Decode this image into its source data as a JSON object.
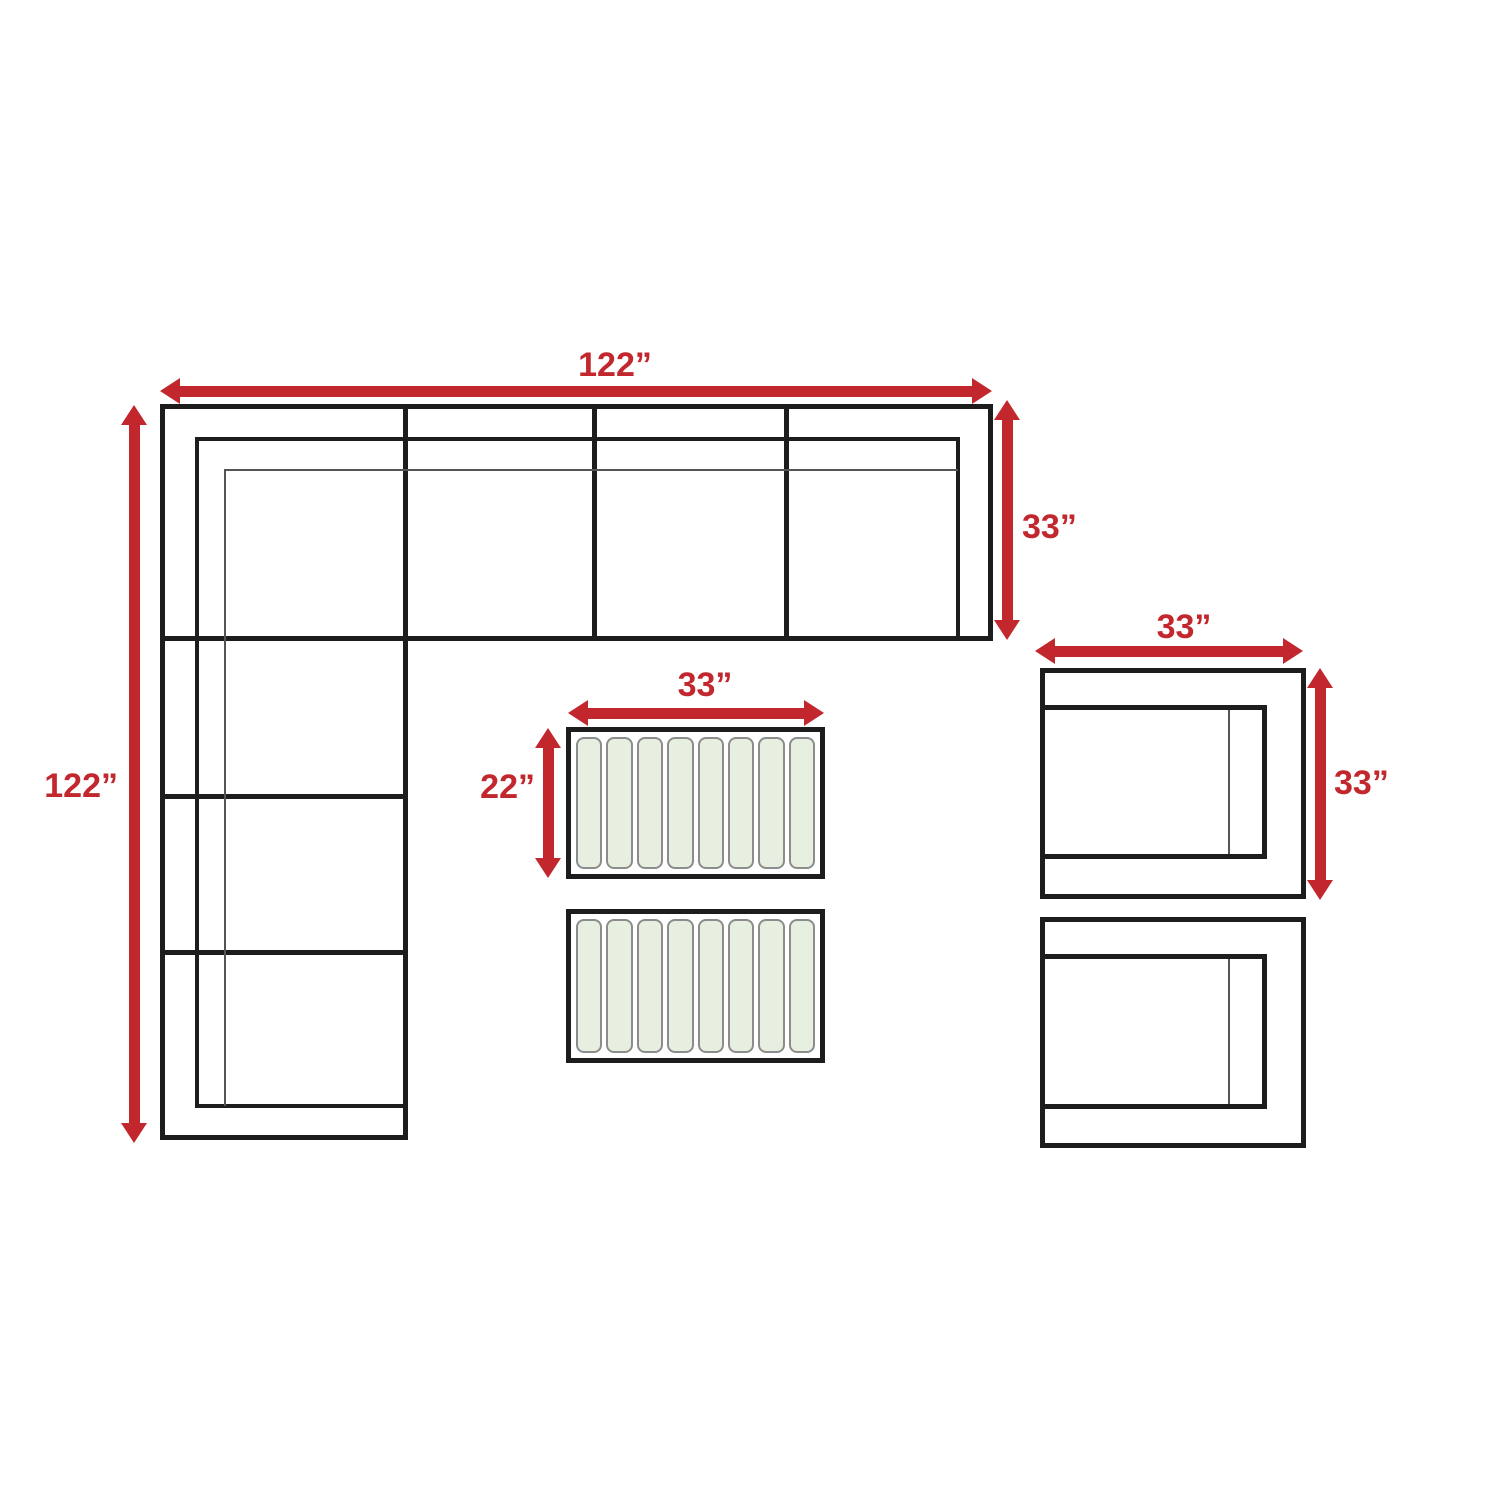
{
  "diagram": {
    "description": "Top-view dimension plan of an outdoor sectional set: L-shaped sectional sofa, two slatted coffee tables, two club chairs",
    "colors": {
      "dimension_red": "#c1272d",
      "outline": "#1d1d1d",
      "thin_line": "#555555",
      "slat_fill": "#e6efe0",
      "slat_border": "#8c8c8c",
      "background": "#ffffff"
    },
    "labels": {
      "sectional_width": "122”",
      "sectional_length": "122”",
      "sectional_depth": "33”",
      "chair_width": "33”",
      "chair_depth": "33”",
      "coffee_table_width": "33”",
      "coffee_table_depth": "22”"
    },
    "pieces": {
      "sectional_sofa": {
        "shape": "L",
        "seat_sections_top_row": 4,
        "seat_sections_left_column": 4
      },
      "coffee_tables": {
        "count": 2,
        "slats_per_table": 8
      },
      "club_chairs": {
        "count": 2
      }
    }
  }
}
